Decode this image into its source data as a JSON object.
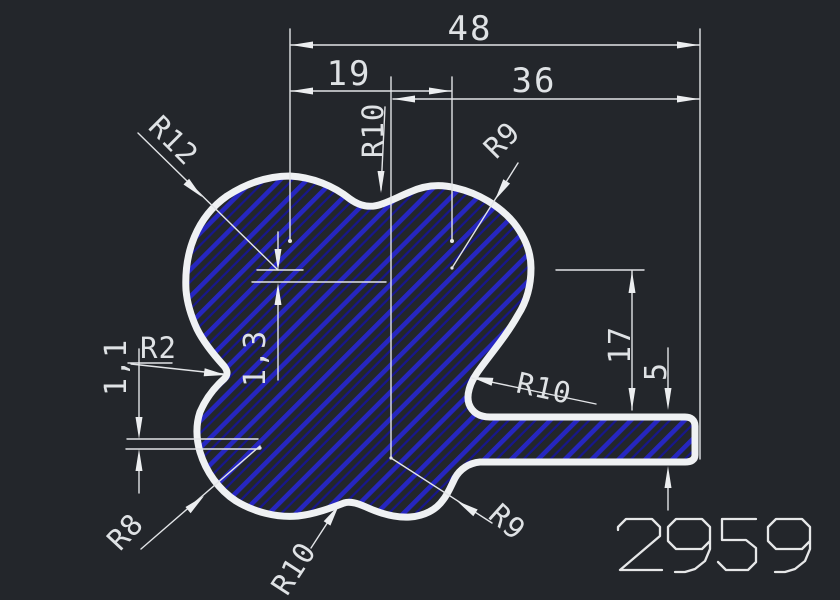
{
  "drawing": {
    "labels": {
      "width_total": "48",
      "width_left": "19",
      "width_right": "36",
      "height_to_tab": "17",
      "tab_thickness": "5",
      "offset_top": "1,3",
      "offset_left": "1,1",
      "radius_top_left": "R12",
      "radius_top_saddle": "R10",
      "radius_top_right": "R9",
      "radius_left_notch": "R2",
      "radius_right_saddle": "R10",
      "radius_bottom_saddle": "R10",
      "radius_bottom_right": "R9",
      "radius_bottom_left": "R8",
      "part_number": "2959"
    },
    "colors": {
      "background": "#23262b",
      "line": "#eff1f3",
      "hatch_primary": "#2626c0",
      "hatch_secondary": "#17178c"
    }
  }
}
